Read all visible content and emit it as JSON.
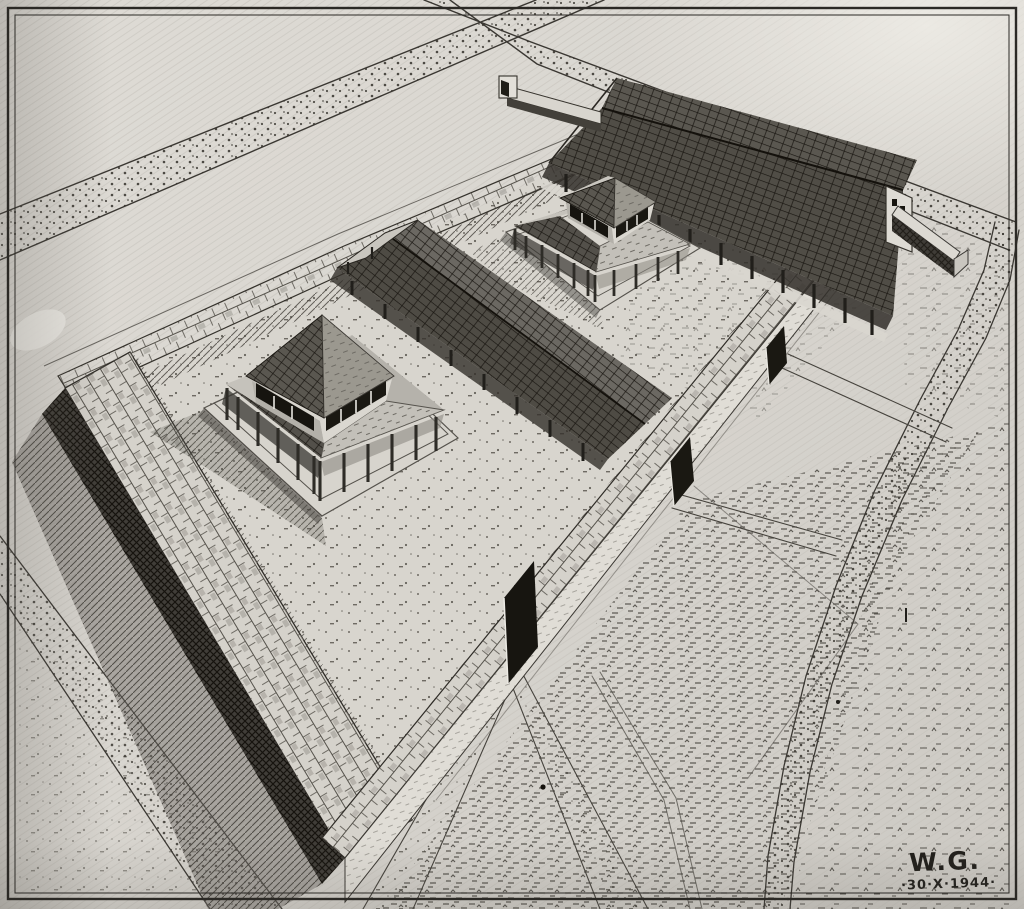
{
  "artwork": {
    "signature_initials": "W.G.",
    "signature_date": "·30·X·1944·",
    "description": "aerial pen-and-ink reconstruction drawing of a walled Gallo-Roman temple precinct: two square temples with ambulatories, long colonnaded galleries, three gates, crossing roads and surrounding fields"
  },
  "palette": {
    "paper": "#dbd8d2",
    "paper_bright": "#eceae4",
    "paper_shade": "#c6c3bd",
    "ink": "#211f1b",
    "ink_soft": "#4a4741",
    "roof_dark": "#504d46",
    "shadow_dark": "#3a3833"
  },
  "scene": {
    "structures": [
      "perimeter-wall",
      "northeast-gallery",
      "central-gallery",
      "west-temple",
      "east-temple",
      "south-gate",
      "middle-gate",
      "north-gate",
      "spur-wall",
      "crossroads",
      "field-roads"
    ]
  }
}
